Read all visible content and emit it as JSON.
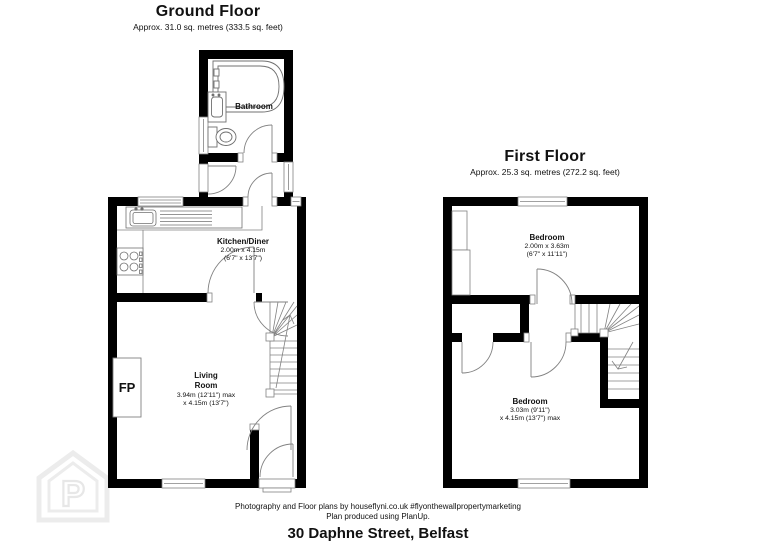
{
  "ground_floor": {
    "title": "Ground Floor",
    "area": "Approx. 31.0 sq. metres (333.5 sq. feet)",
    "bathroom_label": "Bathroom",
    "kitchen": {
      "name": "Kitchen/Diner",
      "dim1": "2.00m x 4.15m",
      "dim2": "(6'7\" x 13'7\")"
    },
    "living": {
      "line1": "Living",
      "line2": "Room",
      "dim1": "3.94m (12'11\") max",
      "dim2": "x 4.15m (13'7\")"
    },
    "fireplace_label": "FP"
  },
  "first_floor": {
    "title": "First Floor",
    "area": "Approx. 25.3 sq. metres (272.2 sq. feet)",
    "bedroom_front": {
      "name": "Bedroom",
      "dim1": "2.00m x 3.63m",
      "dim2": "(6'7\" x 11'11\")"
    },
    "bedroom_back": {
      "name": "Bedroom",
      "dim1": "3.03m (9'11\")",
      "dim2": "x 4.15m (13'7\") max"
    }
  },
  "footer": {
    "credit1": "Photography and Floor plans by houseflyni.co.uk #flyonthewallpropertymarketing",
    "credit2": "Plan produced using PlanUp.",
    "address": "30 Daphne Street, Belfast"
  },
  "watermark": {
    "letter": "P"
  },
  "colors": {
    "wall": "#000000",
    "thin_line": "#7f7f7f",
    "watermark": "#ebebeb",
    "text": "#111111"
  }
}
